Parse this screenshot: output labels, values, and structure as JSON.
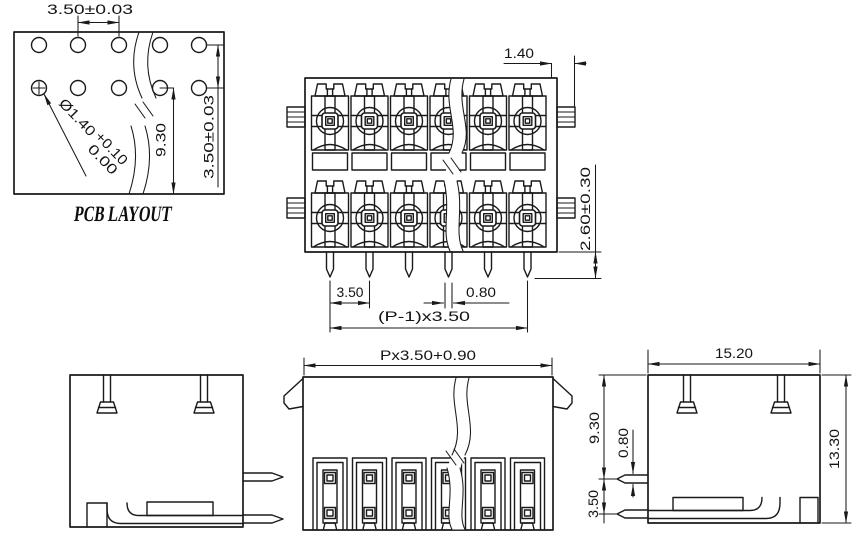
{
  "ink": "#1a1a1a",
  "pcb_view": {
    "title": "PCB LAYOUT",
    "hole_pitch": "3.50±0.03",
    "row_spacing": "3.50±0.03",
    "row_to_edge": "9.30",
    "hole_diameter": "Ø1.40",
    "hole_tol_upper": "+0.10",
    "hole_tol_lower": "0.00"
  },
  "front_view": {
    "tab_width": "1.40",
    "pin_length": "2.60±0.30",
    "pin_pitch": "3.50",
    "pin_width": "0.80",
    "pin_span": "(P-1)x3.50"
  },
  "plug_view": {
    "overall_width": "Px3.50+0.90"
  },
  "side_view": {
    "body_width": "15.20",
    "body_height": "13.30",
    "top_to_pin": "9.30",
    "pin_thickness": "0.80",
    "pin_spacing": "3.50"
  }
}
